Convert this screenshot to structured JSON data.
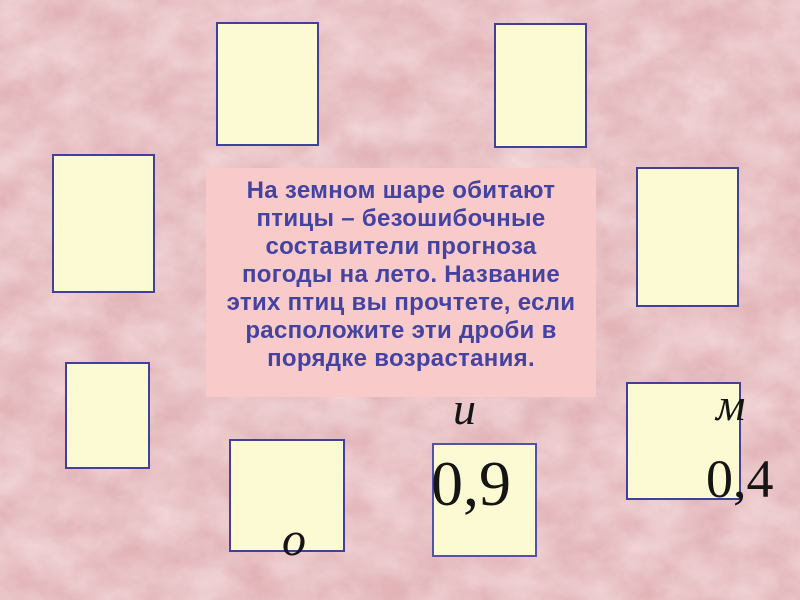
{
  "colors": {
    "background": "#e2b3b7",
    "card_fill": "#fcfad2",
    "card_border": "#41419b",
    "question_fill": "#f8caca",
    "question_text": "#4343a2",
    "annotation_text": "#151515"
  },
  "question": {
    "lines": [
      "На земном шаре обитают",
      "птицы – безошибочные",
      "составители прогноза",
      "погоды на лето. Название",
      "этих птиц вы прочтете, если",
      "расположите эти дроби в",
      "порядке возрастания."
    ]
  },
  "annotations": {
    "letter_i": "и",
    "letter_m": "м",
    "letter_o": "о",
    "value_09": "0,9",
    "value_04": "0,4"
  },
  "cards": [
    {
      "position": "top-center",
      "label": ""
    },
    {
      "position": "top-right",
      "label": ""
    },
    {
      "position": "left-upper",
      "label": ""
    },
    {
      "position": "right-middle",
      "label": ""
    },
    {
      "position": "left-lower",
      "label": ""
    },
    {
      "position": "bottom-center",
      "label": "о"
    },
    {
      "position": "bottom-inner",
      "label": "0,9"
    },
    {
      "position": "right-lower",
      "label": "0,4"
    }
  ]
}
